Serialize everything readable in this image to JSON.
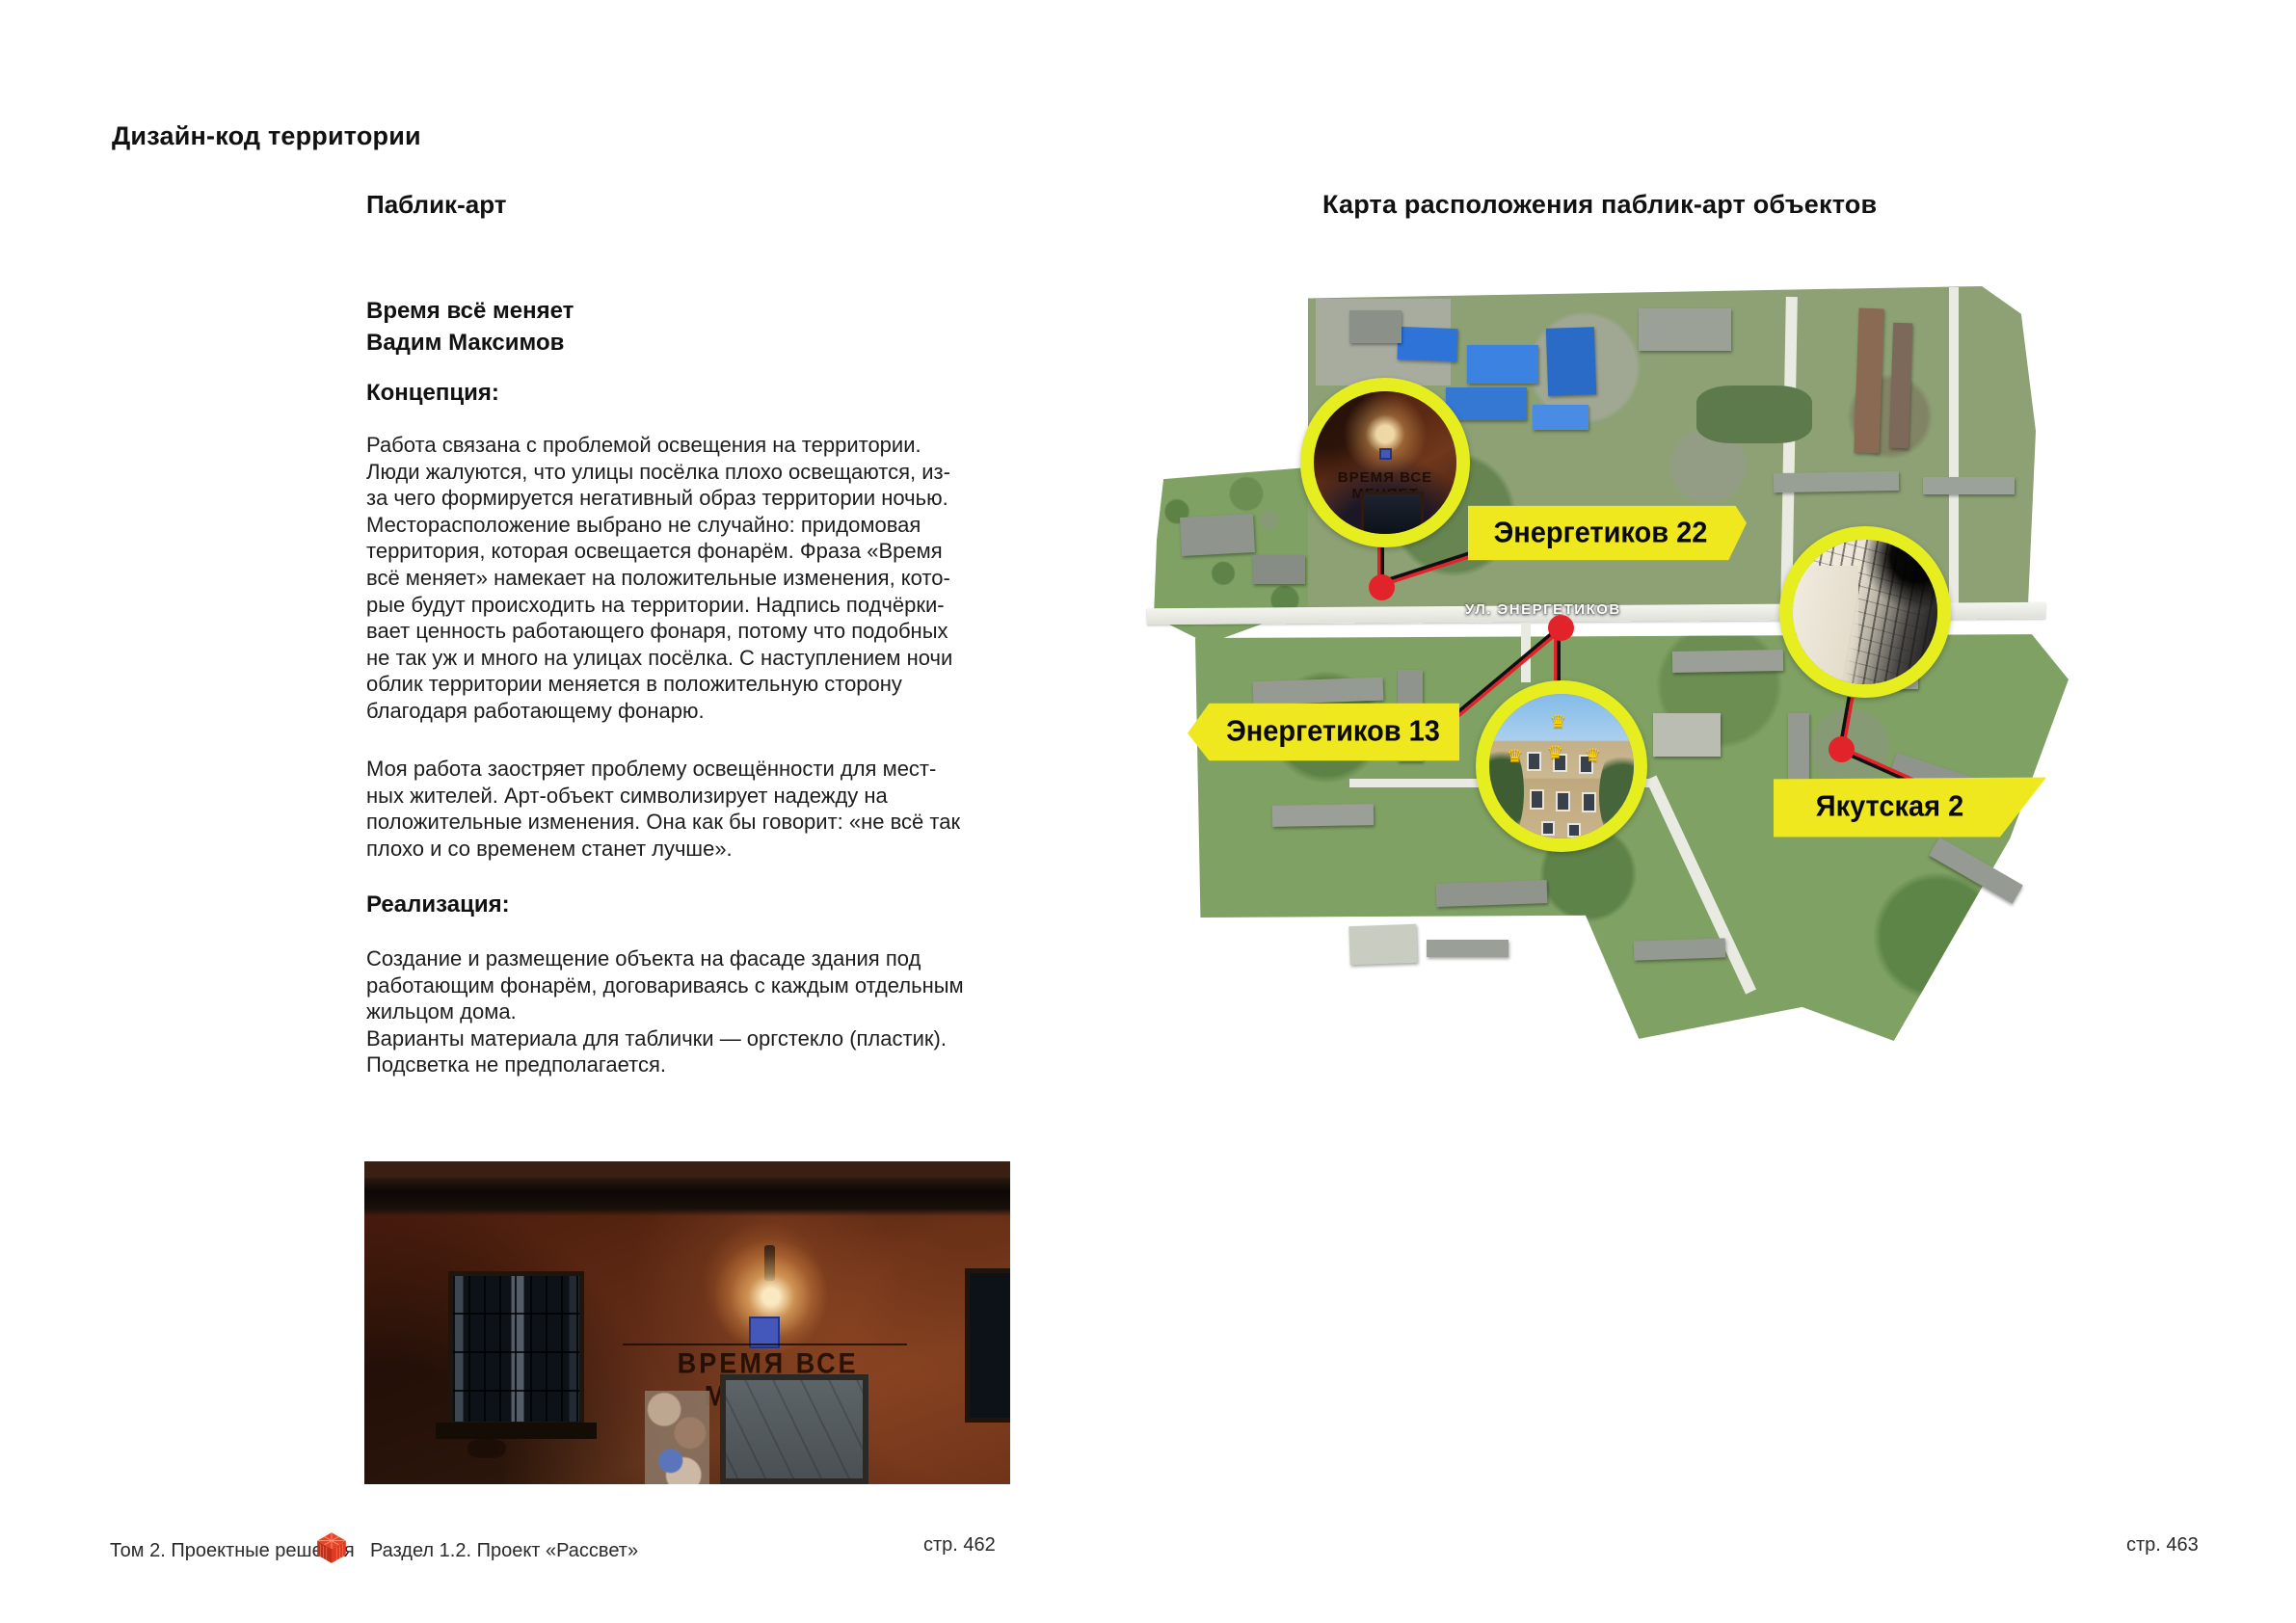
{
  "header": {
    "title": "Дизайн-код территории"
  },
  "left": {
    "section_title": "Паблик-арт",
    "artwork_title": "Время всё меняет",
    "artist": "Вадим Максимов",
    "concept_heading": "Концепция:",
    "concept_p1": "Работа связана с проблемой освещения на территории.\nЛюди жалуются, что улицы посёлка плохо освещаются, из-\nза чего формируется негативный образ территории ночью.\nМесторасположение выбрано не случайно: придомовая\nтерритория, которая освещается фонарём. Фраза «Время\nвсё меняет» намекает на положительные изменения, кото-\nрые будут происходить на территории. Надпись подчёрки-\nвает ценность работающего фонаря, потому что подобных\nне так уж и много на улицах посёлка. С наступлением ночи\nоблик территории меняется в положительную сторону\nблагодаря работающему фонарю.",
    "concept_p2": "Моя работа заостряет проблему освещённости для мест-\nных жителей. Арт-объект символизирует надежду на\nположительные изменения. Она как бы говорит: «не всё так\nплохо и со временем станет лучше».",
    "realization_heading": "Реализация:",
    "realization_p": "Создание и размещение объекта на фасаде здания под\nработающим фонарём, договариваясь с каждым отдельным\nжильцом дома.\nВарианты материала для таблички — оргстекло (пластик).\nПодсветка не предполагается.",
    "photo_inscription": "ВРЕМЯ ВСЕ МЕНЯЕТ"
  },
  "right": {
    "section_title": "Карта расположения паблик-арт объектов",
    "street_label": "УЛ. ЭНЕРГЕТИКОВ",
    "banner_energetikov_22": "Энергетиков 22",
    "banner_energetikov_13": "Энергетиков 13",
    "banner_yakutskaya_2": "Якутская 2",
    "inset1_inscription": "ВРЕМЯ ВСЕ МЕНЯЕТ",
    "crown_glyph": "♛"
  },
  "footer": {
    "volume": "Том 2. Проектные решения",
    "section": "Раздел 1.2. Проект «Рассвет»",
    "page_left": "стр. 462",
    "page_right": "стр. 463"
  },
  "colors": {
    "accent_yellow": "#EFE81F",
    "accent_red": "#E3232A",
    "text": "#1D1D1F"
  }
}
